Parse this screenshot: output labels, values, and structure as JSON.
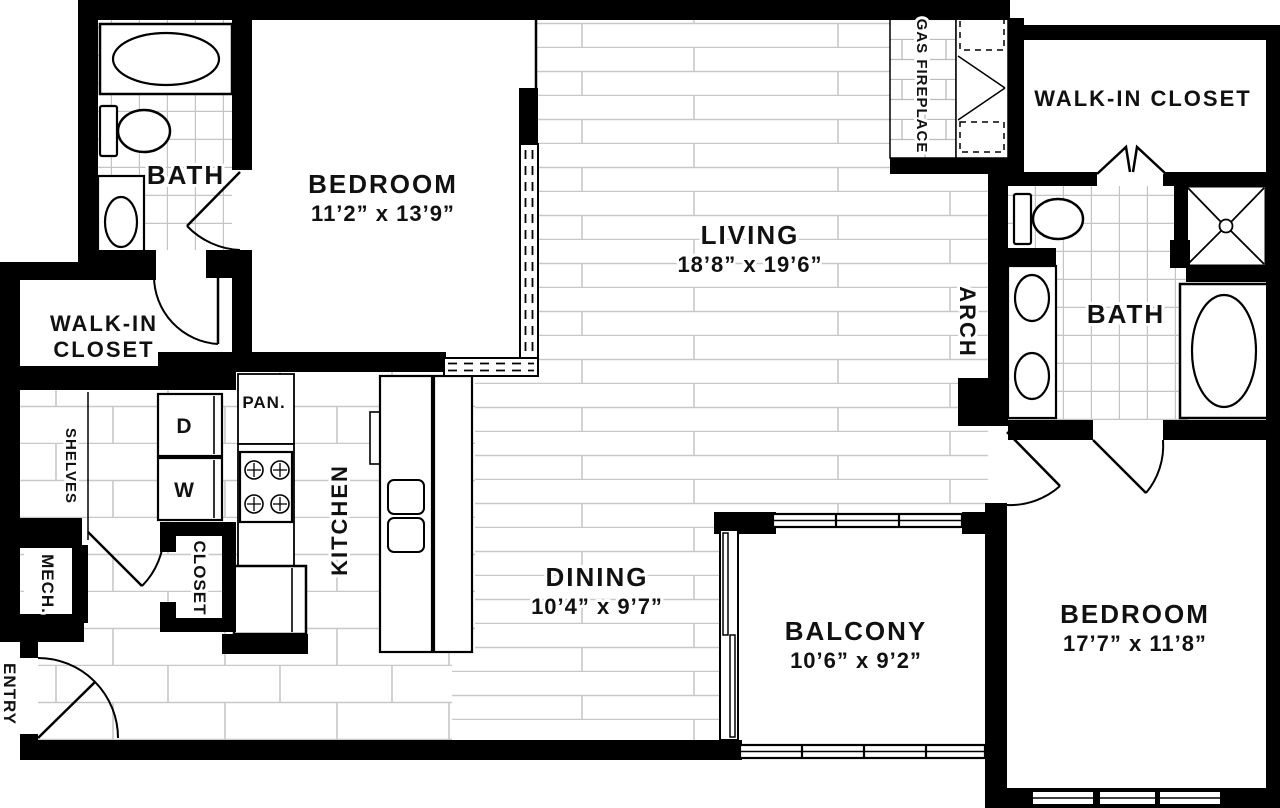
{
  "plan_title": "Two Bedroom Apartment Floor Plan",
  "rooms": {
    "bedroom1": {
      "name": "BEDROOM",
      "dims": "11’2” x 13’9”"
    },
    "living": {
      "name": "LIVING",
      "dims": "18’8” x 19’6”"
    },
    "dining": {
      "name": "DINING",
      "dims": "10’4” x 9’7”"
    },
    "balcony": {
      "name": "BALCONY",
      "dims": "10’6” x 9’2”"
    },
    "bedroom2": {
      "name": "BEDROOM",
      "dims": "17’7” x 11’8”"
    },
    "bath1": {
      "name": "BATH"
    },
    "bath2": {
      "name": "BATH"
    },
    "walk_in_closet_left": {
      "line1": "WALK-IN",
      "line2": "CLOSET"
    },
    "walk_in_closet_right": {
      "name": "WALK-IN CLOSET"
    },
    "kitchen": {
      "name": "KITCHEN"
    },
    "pantry": {
      "name": "PAN."
    },
    "closet": {
      "name": "CLOSET"
    },
    "shelves": {
      "name": "SHELVES"
    },
    "mech": {
      "name": "MECH."
    },
    "entry": {
      "name": "ENTRY"
    },
    "gas_fireplace": {
      "name": "GAS FIREPLACE"
    },
    "arch": {
      "name": "ARCH"
    },
    "dryer": {
      "label": "D"
    },
    "washer": {
      "label": "W"
    }
  },
  "colors": {
    "wall": "#000000",
    "floor_line": "#c8c8c8",
    "background": "#ffffff",
    "text": "#111111"
  }
}
